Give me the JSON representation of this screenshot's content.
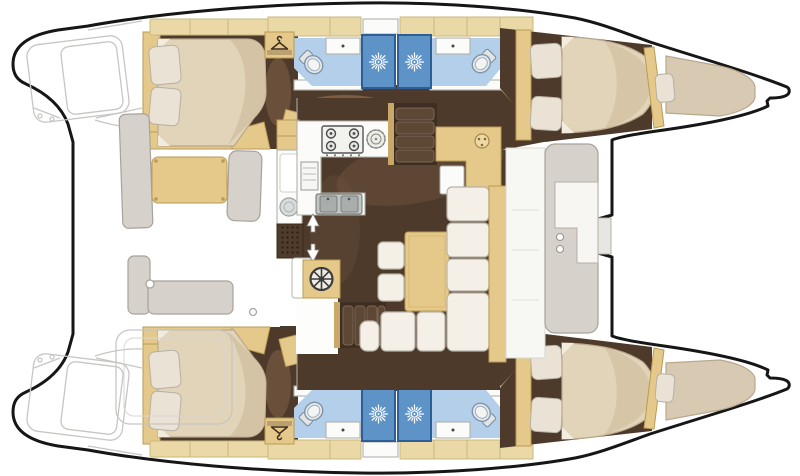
{
  "figure": {
    "kind": "catamaran-interior-floor-plan",
    "orientation": "bows-right-stern-left"
  },
  "colors": {
    "hull_outline": "#161616",
    "paper": "#ffffff",
    "sketch": "#c6c6c3",
    "floor_dark": "#4e3a2b",
    "floor_shade": "#8d6c4f",
    "corridor_shade": "#a9805a",
    "wood_tan": "#e5c98a",
    "wood_tan_dark": "#b99b55",
    "cabinet_beige": "#ead9a6",
    "cabinet_beige_dark": "#c9b87f",
    "mattress": "#e2d4b9",
    "mattress_shade": "#cfbd9c",
    "mattress_edge": "#b9a88e",
    "mattress_fold": "#f2ecdf",
    "pillow": "#eae2d4",
    "pillow_edge": "#b5b0a5",
    "cushion": "#f4f0e7",
    "cushion_edge": "#b8b3a8",
    "bench_gray": "#d6d1cb",
    "bench_gray_edge": "#a8a29a",
    "bath_floor": "#b4cfe9",
    "shower_fill": "#5e93c8",
    "shower_edge": "#2d5e95",
    "sun": "#ffffff",
    "fixture_white": "#fbfbf9",
    "fixture_edge": "#b0b0aa",
    "toilet_edge": "#7d95ad",
    "steel": "#c2c6c4",
    "steel_dark": "#a9aeac",
    "steel_edge": "#6b6f6d",
    "grate": "#503c2b",
    "grate_dot": "#2a1d12",
    "icon_dark": "#3f2d1f",
    "wheel_dark": "#3d3d3d",
    "wheel_face": "#efece4",
    "stair_bg": "#3f2f23",
    "stair_tread": "#5d4836",
    "stair_tread_edge": "#7d6450"
  },
  "icons": [
    "sun-vent-icon",
    "clothes-hanger-icon",
    "helm-wheel-icon",
    "stove-burners-icon",
    "round-burner-icon",
    "double-sink-icon",
    "round-sink-icon",
    "toilet-icon",
    "direction-arrow-icon",
    "nav-instrument-icon"
  ],
  "counts": {
    "cabins": 4,
    "bathrooms": 4,
    "shower_stalls": 4,
    "bow_berths": 2,
    "wardrobes": 4
  }
}
